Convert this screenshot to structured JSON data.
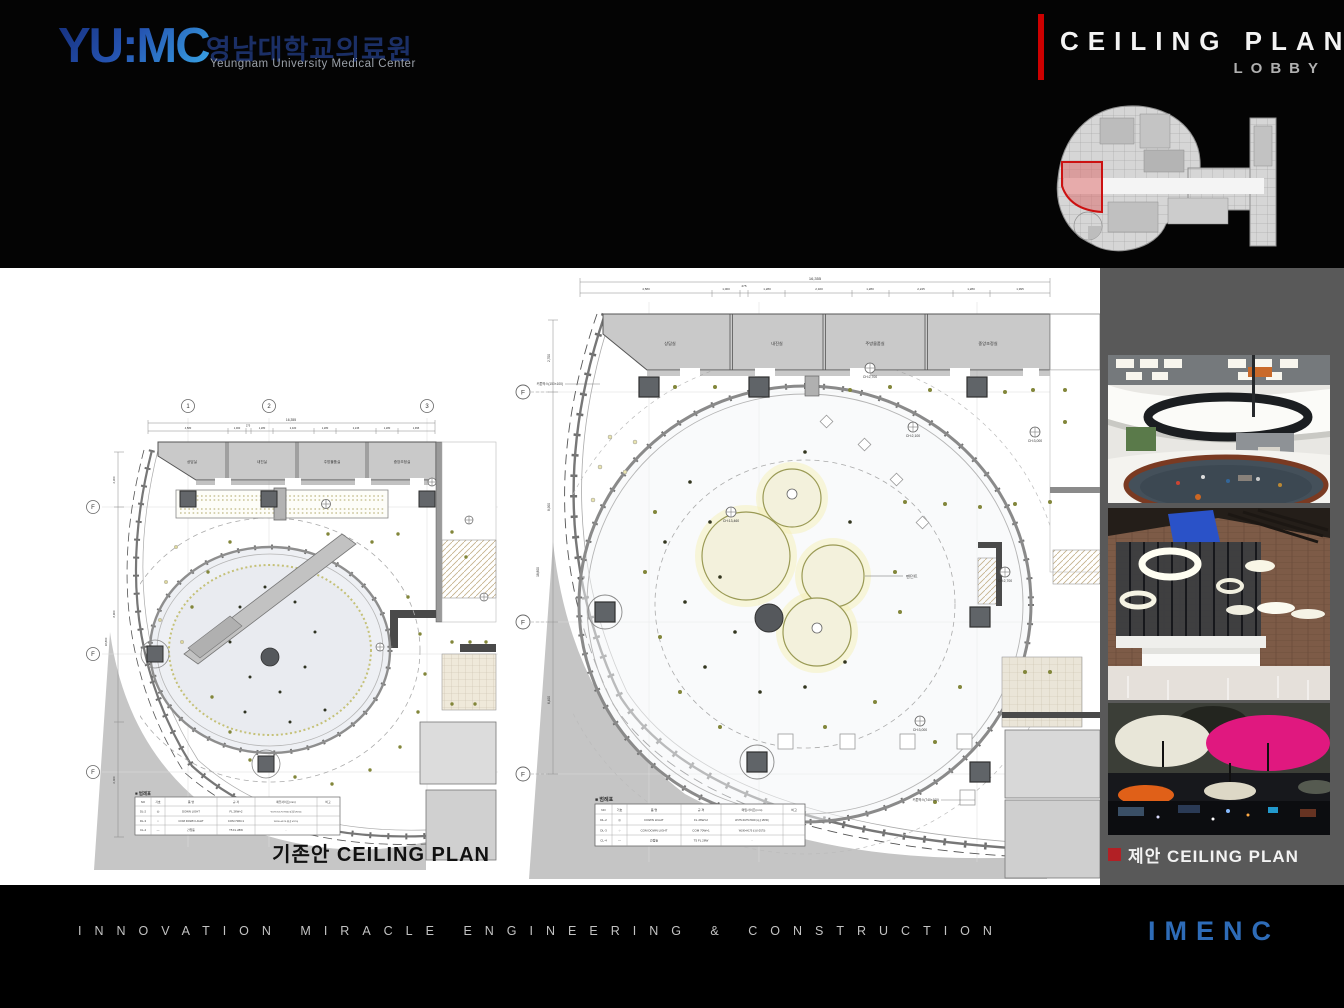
{
  "header": {
    "logo_text": "YU:MC",
    "logo_korean": "영남대학교의료원",
    "logo_english": "Yeungnam University Medical Center",
    "title": "CEILING PLAN",
    "subtitle": "LOBBY"
  },
  "sidebar": {
    "caption": "제안 CEILING PLAN"
  },
  "footer": {
    "tagline": "INNOVATION MIRACLE ENGINEERING & CONSTRUCTION",
    "brand": "IMENC"
  },
  "plans": {
    "left": {
      "caption": "기존안 CEILING PLAN",
      "grid_cols": [
        "1",
        "2",
        "3"
      ],
      "grid_rows": [
        "F",
        "F",
        "F"
      ],
      "dim_total": "16,355",
      "dims_top": [
        "4,580",
        "1,000",
        "275",
        "1,280",
        "2,320",
        "1,280",
        "2,245",
        "1,280",
        "1,995"
      ],
      "dims_left": [
        "2,300",
        "8,900",
        "6,400"
      ],
      "dim_left_total": "18,800",
      "rooms": [
        "상담실",
        "내진실",
        "주방물품실",
        "중앙조정실"
      ]
    },
    "center": {
      "dim_total": "16,355",
      "dims_top": [
        "4,580",
        "1,000",
        "275",
        "1,280",
        "2,320",
        "1,280",
        "2,245",
        "1,280",
        "1,995"
      ],
      "dims_left": [
        "2,700",
        "8,900",
        "6,400"
      ],
      "dim_left_total": "18,800",
      "grid_rows": [
        "F",
        "F",
        "F"
      ],
      "rooms": [
        "상담실",
        "내진실",
        "주방물품실",
        "중앙조정실"
      ],
      "pendant_label": "팬던트",
      "ch_labels": [
        "CH:2,700",
        "CH:2,100",
        "CH:3,000",
        "CH:13,460",
        "CH:3,000",
        "CH:2,700"
      ],
      "notes": [
        "커튼박스(150×100)",
        "커튼박스(740×100)"
      ]
    },
    "legend": {
      "title": "■ 범례표",
      "headers": [
        "NO",
        "기호",
        "품 명",
        "규 격",
        "매입사이즈(mm)",
        "비고"
      ],
      "rows": [
        {
          "no": "DL-2",
          "sym": "◎",
          "name": "DOWN LIGHT",
          "spec": "FL 26W×2",
          "size": "W175×D175×H200 (타공 Ø150)"
        },
        {
          "no": "DL-3",
          "sym": "○",
          "name": "COM DOWN LIGHT",
          "spec": "COM 70W×1",
          "size": "W190×H175 (타공 Ø170)"
        },
        {
          "no": "CL-4",
          "sym": "—",
          "name": "간접등",
          "spec": "T5 FL 28W",
          "size": "-"
        }
      ]
    }
  }
}
